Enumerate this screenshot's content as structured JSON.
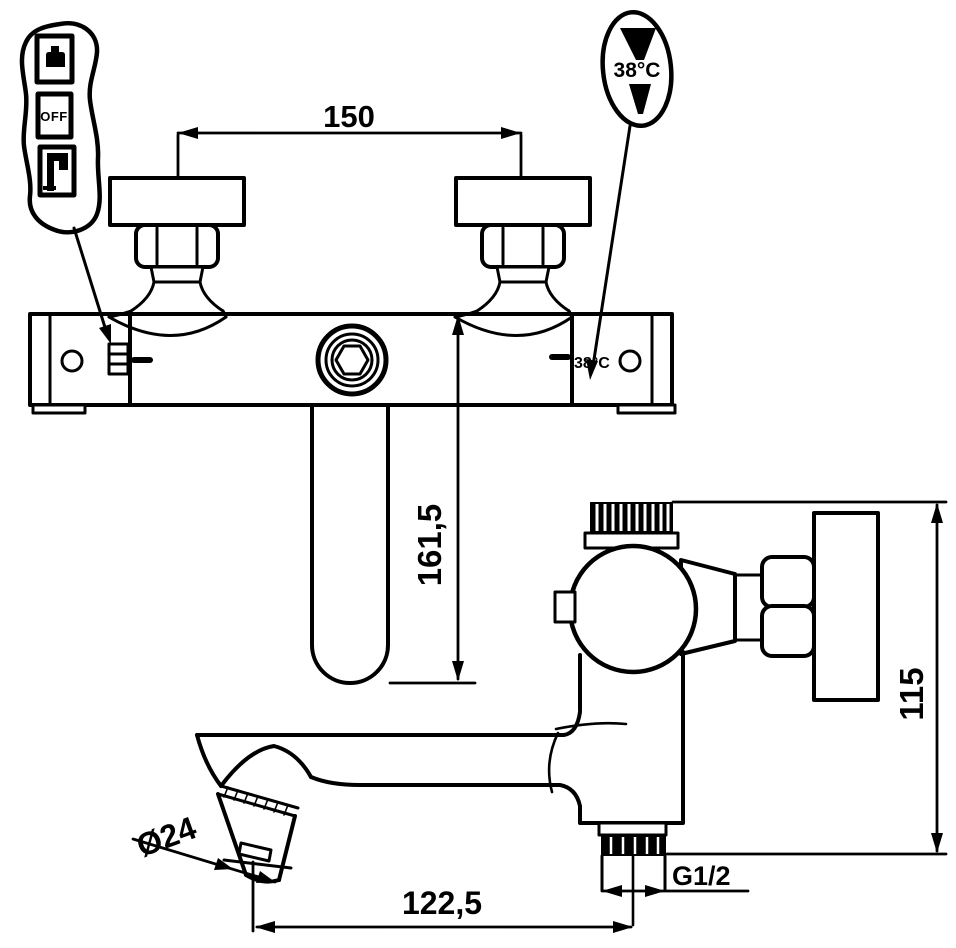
{
  "drawing": {
    "dimensions": {
      "center_distance": "150",
      "spout_drop": "161,5",
      "spout_reach": "122,5",
      "spout_diameter": "Ø24",
      "outlet_thread": "G1/2",
      "body_height": "115"
    },
    "front_view": {
      "temp_stop_label": "38°C"
    },
    "callouts": {
      "temperature_dial": "38°C",
      "mode_off": "OFF"
    },
    "colors": {
      "ink": "#000000",
      "paper": "#ffffff"
    }
  }
}
